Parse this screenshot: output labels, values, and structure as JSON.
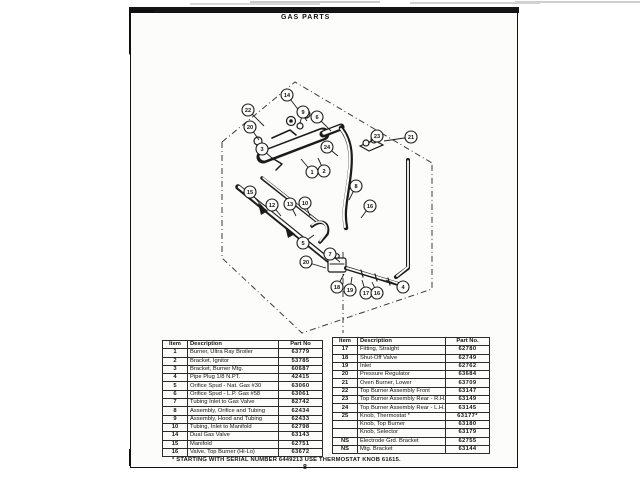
{
  "page": {
    "title": "GAS PARTS",
    "page_number": "8",
    "footnote": "* STARTING WITH SERIAL NUMBER 6449213 USE THERMOSTAT KNOB 61615."
  },
  "parts_table_left": {
    "headers": [
      "Item",
      "Description",
      "Part No"
    ],
    "rows": [
      [
        "1",
        "Burner, Ultra Ray Broiler",
        "63779"
      ],
      [
        "2",
        "Bracket, Ignitor",
        "53785"
      ],
      [
        "3",
        "Bracket, Burner Mtg.",
        "60687"
      ],
      [
        "4",
        "Pipe Plug 1/8 N.PT.",
        "42415"
      ],
      [
        "5",
        "Orifice Spud - Nat. Gas #30",
        "63060"
      ],
      [
        "6",
        "Orifice Spud - L.P. Gas #58",
        "63061"
      ],
      [
        "7",
        "Tubing Inlet to Gas Valve",
        "82742"
      ],
      [
        "8",
        "Assembly, Orifice and Tubing",
        "62434"
      ],
      [
        "9",
        "Assembly, Hood and Tubing",
        "62433"
      ],
      [
        "10",
        "Tubing, Inlet to Manifold",
        "62798"
      ],
      [
        "14",
        "Dual Gas Valve",
        "63143"
      ],
      [
        "15",
        "Manifold",
        "62751"
      ],
      [
        "16",
        "Valve, Top Burner (Hi-Lo)",
        "63672"
      ]
    ]
  },
  "parts_table_right": {
    "headers": [
      "Item",
      "Description",
      "Part No."
    ],
    "rows": [
      [
        "17",
        "Fitting, Straight",
        "62780"
      ],
      [
        "18",
        "Shut-Off Valve",
        "62749"
      ],
      [
        "19",
        "Inlet",
        "62762"
      ],
      [
        "20",
        "Pressure Regulator",
        "63684"
      ],
      [
        "21",
        "Oven Burner, Lower",
        "63709"
      ],
      [
        "22",
        "Top Burner Assembly Front",
        "63147"
      ],
      [
        "23",
        "Top Burner Assembly Rear - R.H.",
        "63149"
      ],
      [
        "24",
        "Top Burner Assembly Rear - L.H.",
        "63145"
      ],
      [
        "25",
        "Knob, Thermostat *",
        "63177*"
      ],
      [
        "",
        "Knob, Top Burner",
        "63180"
      ],
      [
        "",
        "Knob, Selector",
        "63179"
      ],
      [
        "NS",
        "Electrode Grd. Bracket",
        "62755"
      ],
      [
        "NS",
        "Mtg. Bracket",
        "63144"
      ]
    ]
  },
  "diagram": {
    "callouts": [
      {
        "label": "14",
        "x": 287,
        "y": 95,
        "tx": 307,
        "ty": 121
      },
      {
        "label": "22",
        "x": 248,
        "y": 110,
        "tx": 264,
        "ty": 126
      },
      {
        "label": "20",
        "x": 250,
        "y": 127,
        "tx": 259,
        "ty": 140
      },
      {
        "label": "3",
        "x": 262,
        "y": 149,
        "tx": 274,
        "ty": 160
      },
      {
        "label": "9",
        "x": 303,
        "y": 112,
        "tx": 300,
        "ty": 123
      },
      {
        "label": "6",
        "x": 317,
        "y": 117,
        "tx": 331,
        "ty": 131
      },
      {
        "label": "24",
        "x": 327,
        "y": 147,
        "tx": 338,
        "ty": 156
      },
      {
        "label": "1",
        "x": 312,
        "y": 172,
        "tx": 301,
        "ty": 159
      },
      {
        "label": "2",
        "x": 324,
        "y": 171,
        "tx": 318,
        "ty": 158
      },
      {
        "label": "23",
        "x": 377,
        "y": 136,
        "tx": 369,
        "ty": 143
      },
      {
        "label": "21",
        "x": 411,
        "y": 137,
        "tx": 384,
        "ty": 141
      },
      {
        "label": "15",
        "x": 250,
        "y": 192,
        "tx": 267,
        "ty": 212
      },
      {
        "label": "12",
        "x": 272,
        "y": 205,
        "tx": 281,
        "ty": 216
      },
      {
        "label": "13",
        "x": 290,
        "y": 204,
        "tx": 296,
        "ty": 216
      },
      {
        "label": "10",
        "x": 305,
        "y": 203,
        "tx": 310,
        "ty": 216
      },
      {
        "label": "8",
        "x": 356,
        "y": 186,
        "tx": 349,
        "ty": 200
      },
      {
        "label": "16",
        "x": 370,
        "y": 206,
        "tx": 361,
        "ty": 218
      },
      {
        "label": "5",
        "x": 303,
        "y": 243,
        "tx": 314,
        "ty": 235
      },
      {
        "label": "7",
        "x": 330,
        "y": 254,
        "tx": 340,
        "ty": 262
      },
      {
        "label": "20",
        "x": 306,
        "y": 262,
        "tx": 326,
        "ty": 268
      },
      {
        "label": "18",
        "x": 337,
        "y": 287,
        "tx": 344,
        "ty": 274
      },
      {
        "label": "19",
        "x": 350,
        "y": 290,
        "tx": 352,
        "ty": 277
      },
      {
        "label": "17",
        "x": 366,
        "y": 293,
        "tx": 362,
        "ty": 280
      },
      {
        "label": "16",
        "x": 377,
        "y": 293,
        "tx": 372,
        "ty": 282
      },
      {
        "label": "4",
        "x": 403,
        "y": 287,
        "tx": 386,
        "ty": 280
      }
    ]
  }
}
